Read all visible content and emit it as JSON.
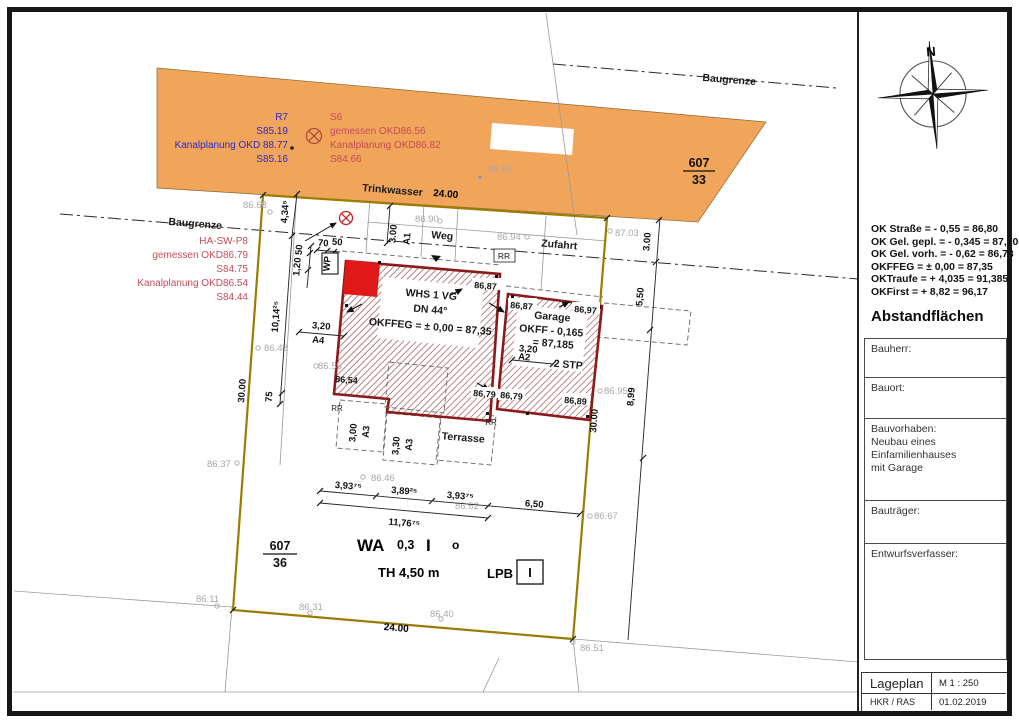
{
  "colors": {
    "street_orange": "#F0A55A",
    "parcel_line": "#9A7D00",
    "building_outline": "#8C1A1A",
    "solid_red": "#E01818",
    "note_red": "#C84B5A",
    "note_blue": "#2B2BC8",
    "survey_gray": "#A8A8A8"
  },
  "street_band": {
    "blue_notes": [
      "R7",
      "S85.19",
      "Kanalplanung OKD 88.77",
      "S85.16"
    ],
    "red_notes": [
      "S6",
      "gemessen OKD86.56",
      "Kanalplanung OKD86.82",
      "S84.66"
    ],
    "trinkwasser": "Trinkwasser",
    "elev_8682": "86.82",
    "parcel_num": "607",
    "parcel_den": "33"
  },
  "labels": {
    "baugrenze": "Baugrenze",
    "weg": "Weg",
    "zufahrt": "Zufahrt",
    "terrasse": "Terrasse"
  },
  "left_notes": [
    "HA-SW-P8",
    "gemessen OKD86.79",
    "S84.75",
    "Kanalplanung OKD86.54",
    "S84.44"
  ],
  "elevations_gray": {
    "e8668": "86.68",
    "e8690": "86.90",
    "e8694": "86.94",
    "e8703": "87.03",
    "e8648": "86.48",
    "e8655": "86.55",
    "e8637": "86.37",
    "e8611": "86.11",
    "e8631": "86.31",
    "e8640": "86.40",
    "e8651": "86.51",
    "e8646": "86.46",
    "e8662": "86.62",
    "e8695": "86.95",
    "e8667": "86.67"
  },
  "elevations_black": {
    "p1": "86,87",
    "p2": "86,87",
    "p3": "86,97",
    "p4": "86,54",
    "p5": "86,79",
    "p6": "86,79",
    "p7": "86,89"
  },
  "house": {
    "line1": "WHS 1 VG",
    "line2": "DN 44°",
    "line3": "OKFFEG = ± 0,00 = 87,35"
  },
  "garage": {
    "line1": "Garage",
    "line2": "OKFF - 0,165",
    "line3": "= 87,185",
    "stp": "2 STP"
  },
  "dims": {
    "d2400": "24.00",
    "d3000": "30.00",
    "d434": "4,34⁵",
    "d1014": "10,14²⁵",
    "d75": "75",
    "d320": "3,20",
    "a4": "A4",
    "a2": "A2",
    "d70": "70",
    "d50": "50",
    "d120": "1,20",
    "wp": "WP",
    "d300": "3.00",
    "a1": "A1",
    "rr": "RR",
    "d300c": "3,00",
    "d330": "3,30",
    "a3": "A3",
    "d39375": "3,93⁷⁵",
    "d38925": "3,89²⁵",
    "d650": "6,50",
    "d117675": "11,76⁷⁵",
    "d550": "5,50",
    "d899": "8,99"
  },
  "zone": {
    "parcel_num": "607",
    "parcel_den": "36",
    "wa": "WA",
    "ratio": "0,3",
    "roman": "I",
    "open": "o",
    "th": "TH 4,50 m",
    "lpb": "LPB",
    "lpb_value": "I"
  },
  "panel": {
    "levels": [
      "OK Straße = - 0,55 = 86,80",
      "OK Gel. gepl. = - 0,345 = 87,005",
      "OK Gel. vorh. = - 0,62 = 86,73",
      "OKFFEG = ± 0,00 = 87,35",
      "OKTraufe = + 4,035 = 91,385",
      "OKFirst = + 8,82 = 96,17"
    ],
    "abstand_title": "Abstandflächen",
    "rows": {
      "bauherr": "Bauherr:",
      "bauort": "Bauort:",
      "bauvorhaben": "Bauvorhaben:",
      "bv_line1": "Neubau eines Einfamilienhauses",
      "bv_line2": "mit Garage",
      "bautraeger": "Bauträger:",
      "entwurf": "Entwurfsverfasser:"
    },
    "titleblock": {
      "title": "Lageplan",
      "scale": "M  1 : 250",
      "initials": "HKR / RAS",
      "date": "01.02.2019"
    },
    "north": "N"
  }
}
